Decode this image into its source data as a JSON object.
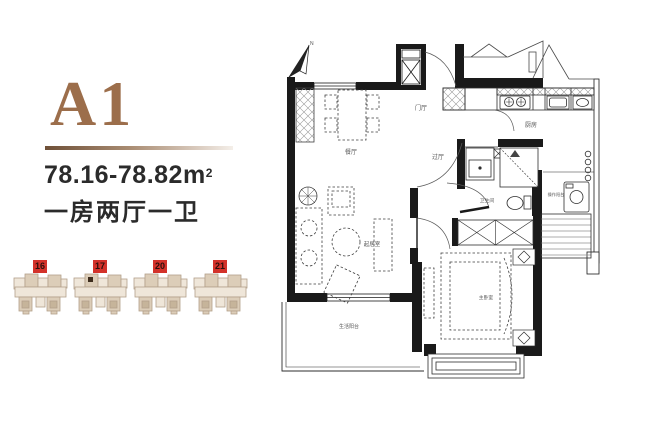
{
  "left_panel": {
    "unit_code": "A1",
    "area_value": "78.16-78.82",
    "area_unit": "m",
    "area_superscript": "2",
    "layout_description": "一房两厅一卫",
    "buildings": [
      {
        "number": "16",
        "marked": false
      },
      {
        "number": "17",
        "marked": true
      },
      {
        "number": "20",
        "marked": false
      },
      {
        "number": "21",
        "marked": false
      }
    ]
  },
  "floor_plan": {
    "north_label": "N",
    "room_labels": [
      {
        "id": "dining",
        "text": "餐厅"
      },
      {
        "id": "foyer",
        "text": "门厅"
      },
      {
        "id": "kitchen",
        "text": "厨房"
      },
      {
        "id": "hall",
        "text": "过厅"
      },
      {
        "id": "bathroom",
        "text": "卫生间"
      },
      {
        "id": "service-balcony",
        "text": "操作阳台"
      },
      {
        "id": "living",
        "text": "起居室"
      },
      {
        "id": "master-bedroom",
        "text": "主卧室"
      },
      {
        "id": "living-balcony",
        "text": "生活阳台"
      }
    ]
  },
  "colors": {
    "accent_brown": "#9c6e4b",
    "badge_red": "#d3322a",
    "text_dark": "#2b2b2b",
    "wall_black": "#1a1a1a",
    "thumb_fill_light": "#efe6d9",
    "thumb_fill_mid": "#dccdb8",
    "thumb_fill_dark": "#c6b49a"
  }
}
